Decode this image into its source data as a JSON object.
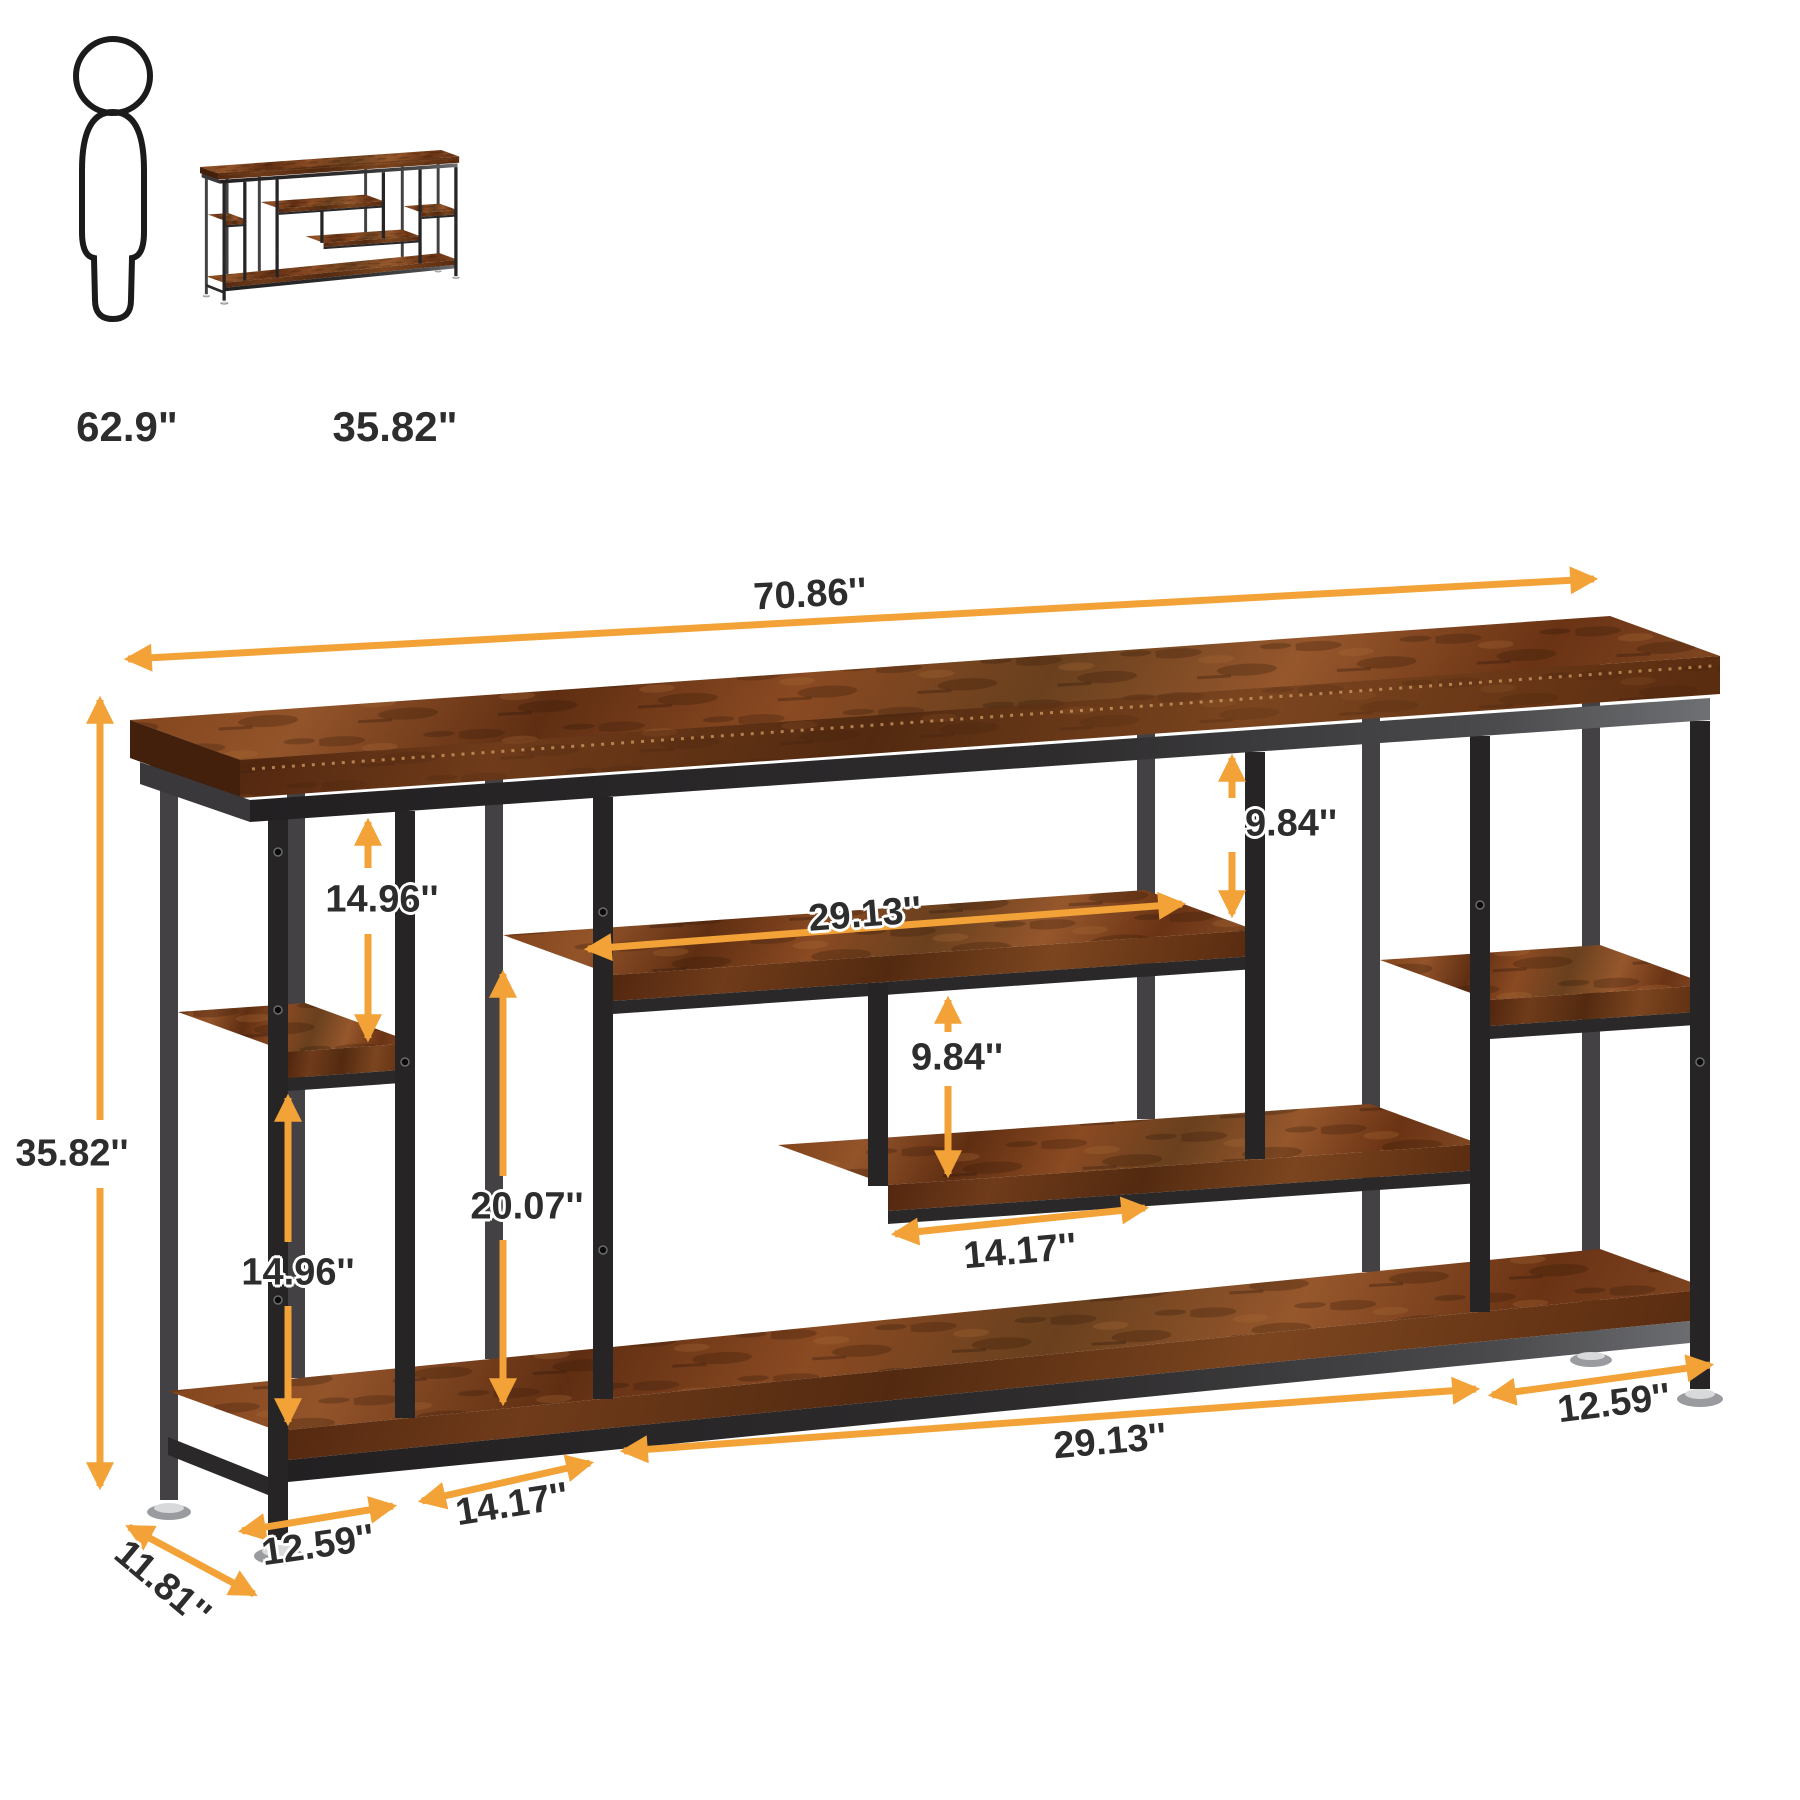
{
  "legend": {
    "person_height_label": "62.9\"",
    "product_width_label": "35.82\""
  },
  "dimensions": {
    "top_width": "70.86''",
    "overall_height": "35.82''",
    "left_bay_upper_height": "14.96''",
    "left_bay_lower_height": "14.96''",
    "center_clearance_height": "20.07''",
    "top_right_gap_height": "9.84''",
    "center_gap_height": "9.84''",
    "upper_shelf_length": "29.13''",
    "mid_shelf_length": "14.17''",
    "bottom_bay_1": "12.59''",
    "bottom_bay_2": "14.17''",
    "bottom_bay_3": "29.13''",
    "bottom_bay_4": "12.59''",
    "depth": "11.81''"
  },
  "colors": {
    "arrow": "#F2A237",
    "label_text": "#2D2D2D",
    "metal_dark": "#262425",
    "metal_light": "#6F7073",
    "wood_mid": "#7C4420",
    "background": "#FFFFFF"
  },
  "icons": {
    "person": "person-outline-icon",
    "product": "console-table-thumbnail"
  }
}
